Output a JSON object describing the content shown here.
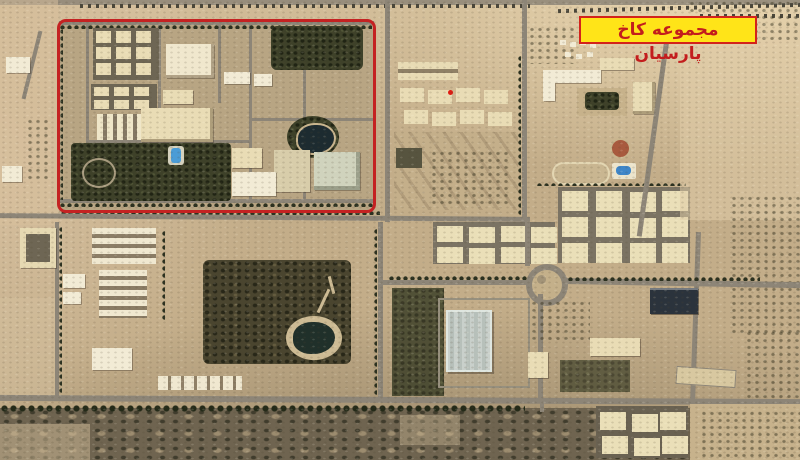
{
  "scene": {
    "type": "oblique satellite aerial photograph of a desert compound and surrounding urban blocks",
    "annotation_label": "مجموعه کاخ پارسیان"
  },
  "colors": {
    "annotation_red": "#C42222",
    "label_bg": "#FFE418",
    "label_border": "#D3231B",
    "label_text": "#C31D1D",
    "desert_base": "#C3AD89",
    "road_gray": "#8D8577",
    "building_cream": "#E9DCB5",
    "vegetation_dark": "#3E4129",
    "pond_dark": "#1D2B30",
    "pool_blue": "#4B9CD6"
  }
}
